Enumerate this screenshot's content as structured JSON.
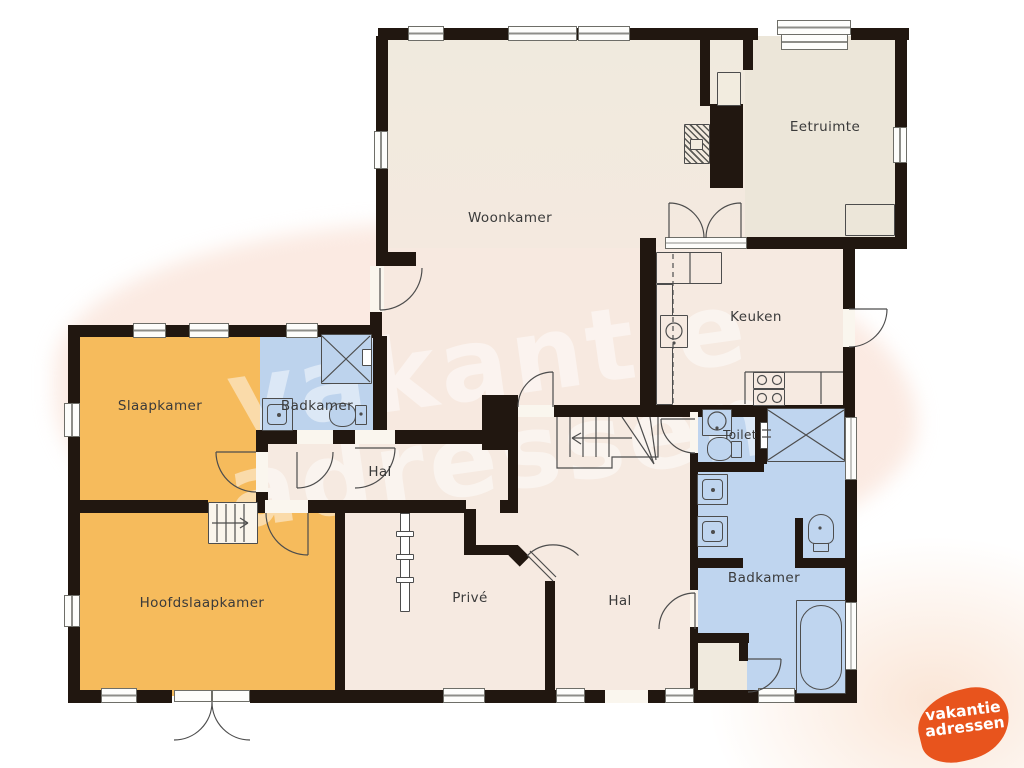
{
  "document": {
    "kind": "floor-plan"
  },
  "watermark": {
    "line1": "vakantie",
    "line2": "adressen"
  },
  "logo": {
    "line1": "vakantie",
    "line2": "adressen",
    "color": "#e8541d"
  },
  "rooms": {
    "woonkamer": {
      "label": "Woonkamer"
    },
    "eetruimte": {
      "label": "Eetruimte"
    },
    "keuken": {
      "label": "Keuken"
    },
    "slaapkamer": {
      "label": "Slaapkamer"
    },
    "badkamer_boven": {
      "label": "Badkamer"
    },
    "hal_boven": {
      "label": "Hal"
    },
    "toilet": {
      "label": "Toilet"
    },
    "hoofdslaapkamer": {
      "label": "Hoofdslaapkamer"
    },
    "prive": {
      "label": "Privé"
    },
    "hal_beneden": {
      "label": "Hal"
    },
    "badkamer_beneden": {
      "label": "Badkamer"
    }
  },
  "colors": {
    "wall": "#211710",
    "floor_beige": "#ece6d9",
    "floor_tinted": "#f7eae1",
    "bedroom_orange": "#f6bb5c",
    "bathroom_blue": "#bfd5ef",
    "watermark_blob": "#f7d8ca",
    "logo_orange": "#e8541d",
    "outline": "#4d4d4d",
    "label_text": "#3a3a3a"
  }
}
